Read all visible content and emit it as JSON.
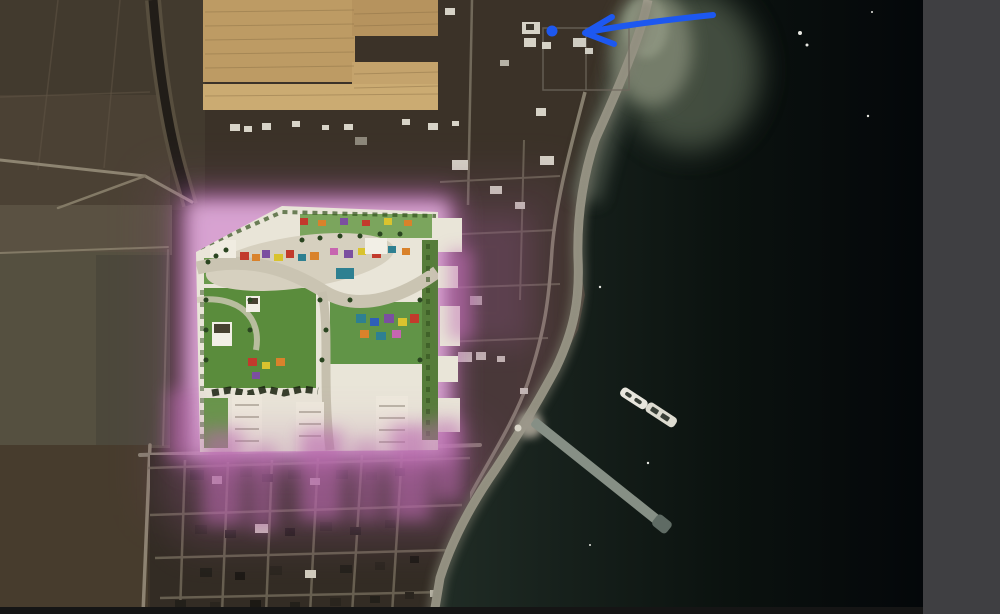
{
  "frame": {
    "kind": "annotated satellite aerial view",
    "side_panel_color": "#3f3f42",
    "bottom_bar_color": "#151515"
  },
  "map": {
    "land_color": "#3b3228",
    "sea_color_near_coast": "#212d26",
    "sea_color_offshore": "#04070a",
    "beach_color": "#a8a394",
    "tan_field_color": "#bd9b64",
    "site_plan": {
      "label": "masterplan overlay",
      "glow_color": "#c873c2",
      "base_color": "#e9e5d8",
      "lawn_color": "#5a8c3c"
    },
    "ships_count": 2,
    "pier": "breakwater pier"
  },
  "annotation": {
    "tool": "pen",
    "color": "#1d58f0",
    "shapes": [
      "curved arrow",
      "dot marker"
    ],
    "arrow": {
      "tail_x": 713,
      "tail_y": 15,
      "tip_x": 584,
      "tip_y": 33
    },
    "dot": {
      "cx": 552,
      "cy": 31,
      "r": 5.5
    }
  }
}
